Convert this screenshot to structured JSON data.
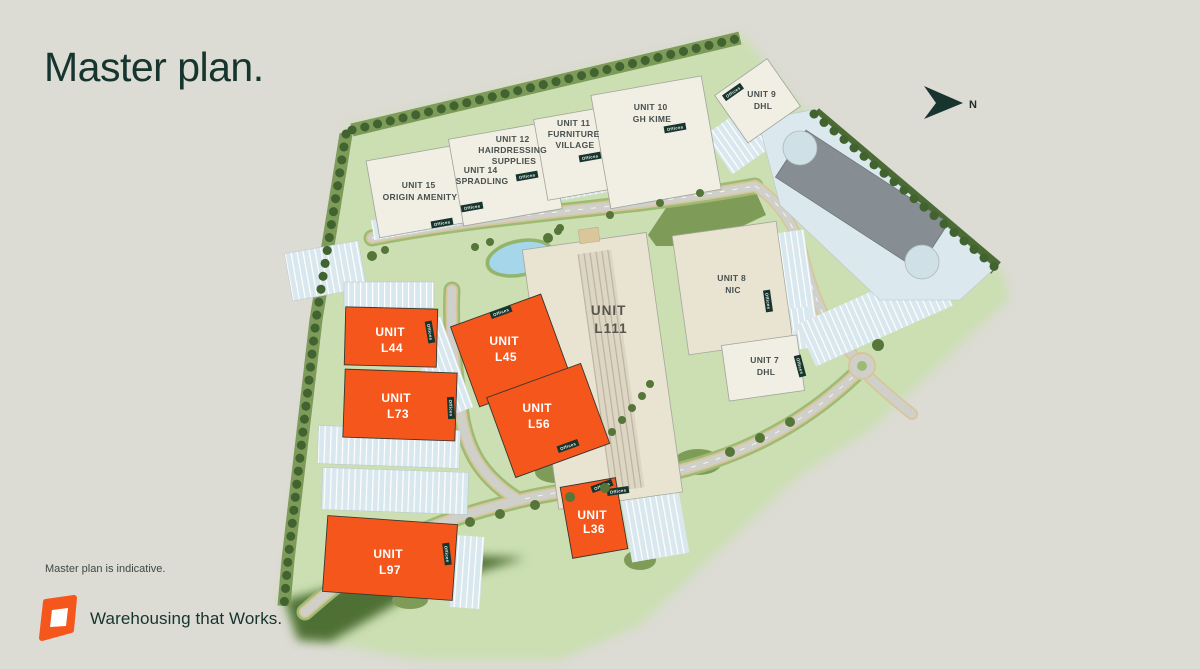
{
  "page": {
    "title": "Master plan.",
    "disclaimer": "Master plan is indicative.",
    "tagline": "Warehousing that Works.",
    "north_label": "N"
  },
  "colors": {
    "page_background": "#dcdbd4",
    "brand_dark_green": "#16352e",
    "available_unit_orange": "#f4561c",
    "site_green": "#cbdfb2",
    "woodland_green": "#4c6b34",
    "building_white": "#f1eee3",
    "building_cream": "#e9e3d1",
    "parking_blue": "#d9e8ee",
    "pond_blue": "#a5d6e9",
    "road_grey": "#cfd0ca",
    "existing_building_grey": "#878e93"
  },
  "plan": {
    "offices_label": "Offices",
    "units": {
      "u15": {
        "lines": [
          "UNIT 15",
          "ORIGIN AMENITY"
        ]
      },
      "u14": {
        "lines": [
          "UNIT 14",
          "SPRADLING"
        ]
      },
      "u12": {
        "lines": [
          "UNIT 12",
          "HAIRDRESSING",
          "SUPPLIES"
        ]
      },
      "u11": {
        "lines": [
          "UNIT 11",
          "FURNITURE",
          "VILLAGE"
        ]
      },
      "u10": {
        "lines": [
          "UNIT 10",
          "GH KIME"
        ]
      },
      "u9": {
        "lines": [
          "UNIT 9",
          "DHL"
        ]
      },
      "u8": {
        "lines": [
          "UNIT 8",
          "NIC"
        ]
      },
      "u7": {
        "lines": [
          "UNIT 7",
          "DHL"
        ]
      },
      "l111": {
        "lines": [
          "UNIT",
          "L111"
        ]
      },
      "l44": {
        "lines": [
          "UNIT",
          "L44"
        ]
      },
      "l45": {
        "lines": [
          "UNIT",
          "L45"
        ]
      },
      "l56": {
        "lines": [
          "UNIT",
          "L56"
        ]
      },
      "l73": {
        "lines": [
          "UNIT",
          "L73"
        ]
      },
      "l97": {
        "lines": [
          "UNIT",
          "L97"
        ]
      },
      "l36": {
        "lines": [
          "UNIT",
          "L36"
        ]
      }
    }
  }
}
